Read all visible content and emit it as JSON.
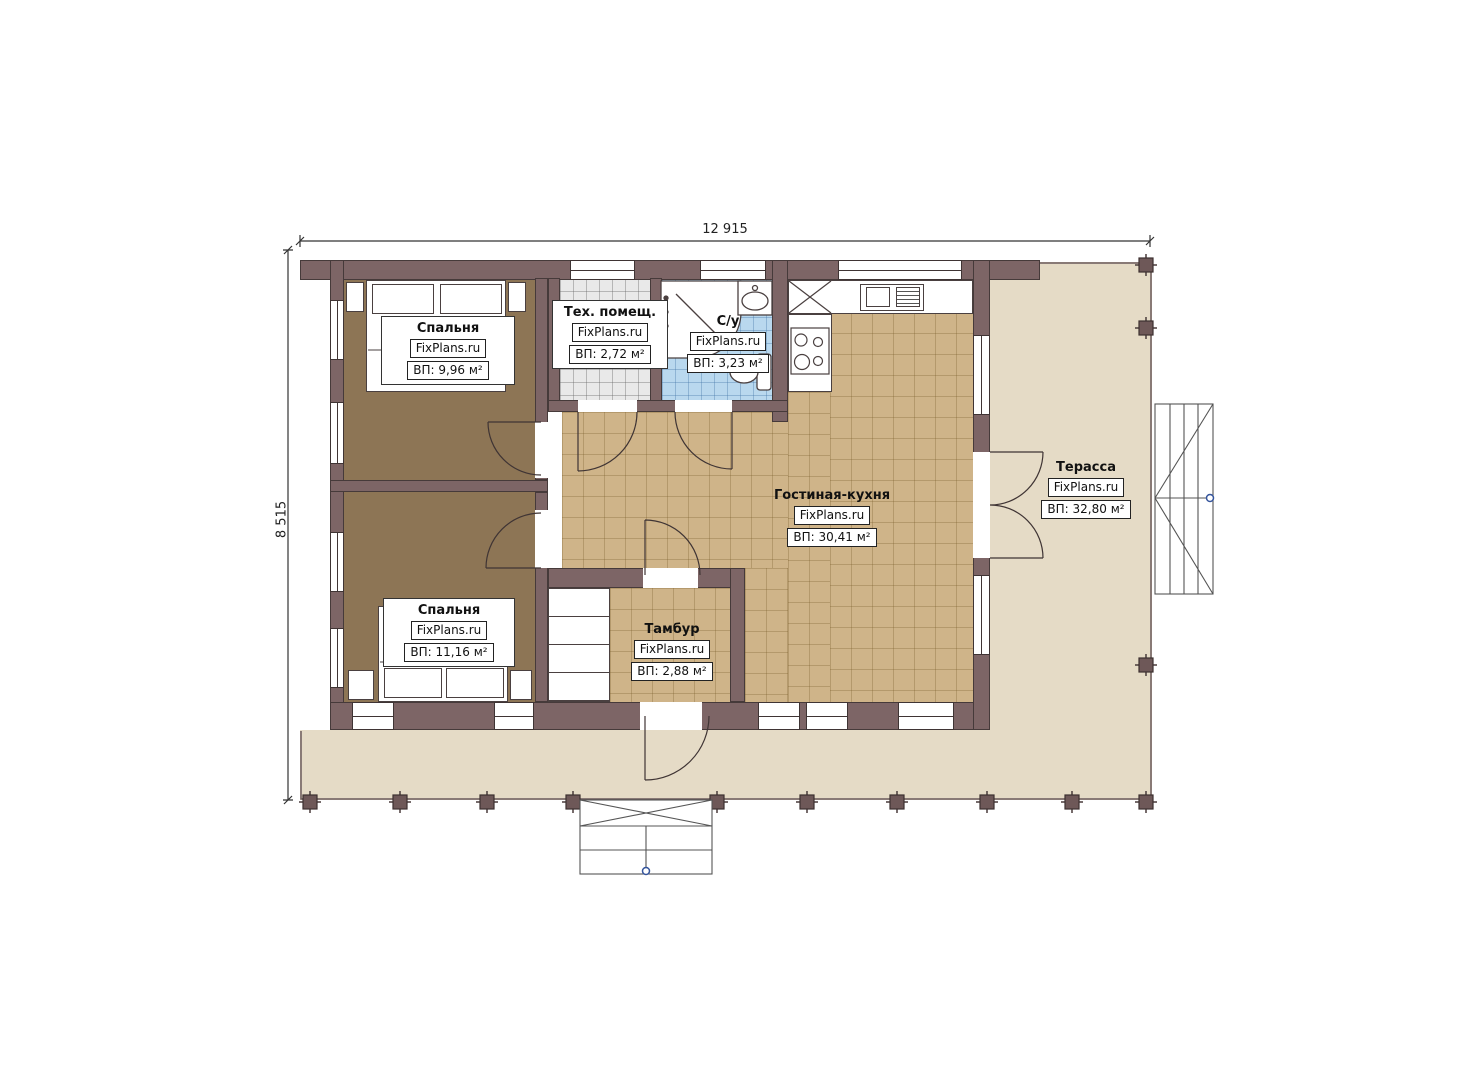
{
  "colors": {
    "wall": "#7d6566",
    "wall_outline": "#463a3a",
    "bedroom_floor": "#8d7555",
    "tile_floor": "#cfb489",
    "tech_floor": "#e9e9e9",
    "bath_floor": "#b9d8ee",
    "terrace_floor": "#e5dbc6",
    "line": "#3f3434",
    "marker": "#34549c"
  },
  "dimensions": {
    "width_label": "12 915",
    "height_label": "8 515"
  },
  "rooms": [
    {
      "name": "Спальня",
      "watermark": "FixPlans.ru",
      "area": "ВП: 9,96 м²"
    },
    {
      "name": "Тех. помещ.",
      "watermark": "FixPlans.ru",
      "area": "ВП: 2,72 м²"
    },
    {
      "name": "С/у",
      "watermark": "FixPlans.ru",
      "area": "ВП: 3,23 м²"
    },
    {
      "name": "Гостиная-кухня",
      "watermark": "FixPlans.ru",
      "area": "ВП: 30,41 м²"
    },
    {
      "name": "Спальня",
      "watermark": "FixPlans.ru",
      "area": "ВП: 11,16 м²"
    },
    {
      "name": "Тамбур",
      "watermark": "FixPlans.ru",
      "area": "ВП: 2,88 м²"
    },
    {
      "name": "Терасса",
      "watermark": "FixPlans.ru",
      "area": "ВП: 32,80 м²"
    }
  ]
}
